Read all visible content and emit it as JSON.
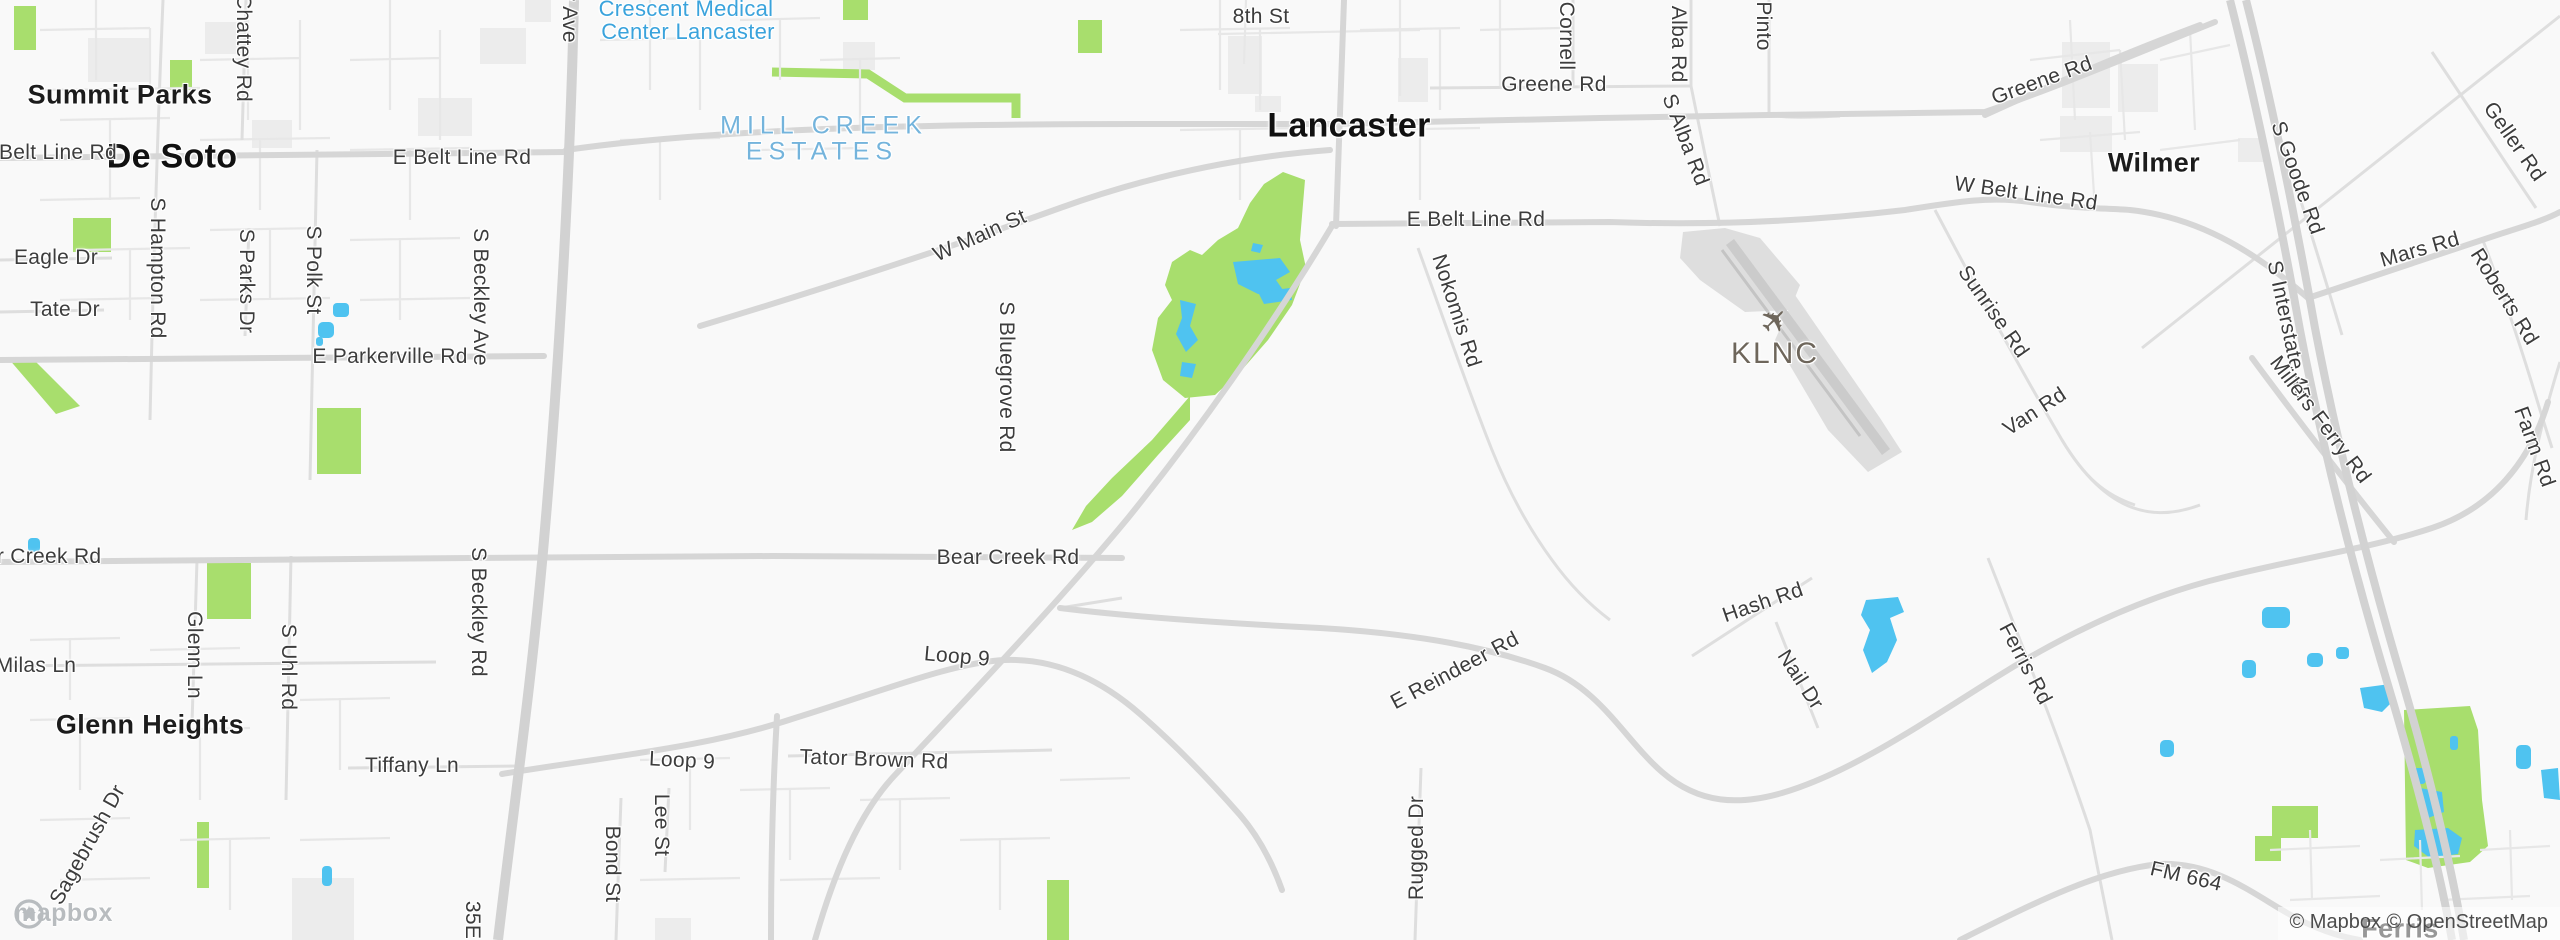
{
  "map": {
    "attribution": "© Mapbox © OpenStreetMap",
    "logo_text": "mapbox"
  },
  "icons": {
    "airplane": "✈",
    "mapbox_badge": "mapbox-circle-badge"
  },
  "colors": {
    "park": "#a8de6d",
    "water": "#4fc3f0",
    "road_major": "#d6d6d6",
    "road_minor": "#e7e7e7",
    "poi_blue": "#3aa3dc",
    "area_blue": "#74b4dc",
    "airport_label": "#6e665b"
  },
  "labels": [
    {
      "n": "summit-parks",
      "t": "Summit Parks",
      "x": 120,
      "y": 95,
      "r": 0,
      "c": "city"
    },
    {
      "n": "de-soto",
      "t": "De Soto",
      "x": 172,
      "y": 157,
      "r": 0,
      "c": "city-lg"
    },
    {
      "n": "lancaster",
      "t": "Lancaster",
      "x": 1349,
      "y": 126,
      "r": 0,
      "c": "city-lg"
    },
    {
      "n": "wilmer",
      "t": "Wilmer",
      "x": 2154,
      "y": 163,
      "r": 0,
      "c": "city"
    },
    {
      "n": "glenn-heights",
      "t": "Glenn Heights",
      "x": 150,
      "y": 725,
      "r": 0,
      "c": "city"
    },
    {
      "n": "ferris",
      "t": "Ferris",
      "x": 2400,
      "y": 929,
      "r": 0,
      "c": "city"
    },
    {
      "n": "belt-line-rd-west-edge",
      "t": "Belt Line Rd",
      "x": 58,
      "y": 153,
      "r": 0
    },
    {
      "n": "e-belt-line-rd-desoto",
      "t": "E Belt Line Rd",
      "x": 462,
      "y": 158,
      "r": 0
    },
    {
      "n": "chattey-rd",
      "t": "Chattey Rd",
      "x": 243,
      "y": 48,
      "r": 90
    },
    {
      "n": "s-hampton-rd",
      "t": "S Hampton Rd",
      "x": 157,
      "y": 268,
      "r": 90
    },
    {
      "n": "eagle-dr",
      "t": "Eagle Dr",
      "x": 56,
      "y": 258,
      "r": 0
    },
    {
      "n": "tate-dr",
      "t": "Tate Dr",
      "x": 65,
      "y": 310,
      "r": 0
    },
    {
      "n": "s-parks-dr",
      "t": "S Parks Dr",
      "x": 246,
      "y": 281,
      "r": 90
    },
    {
      "n": "s-polk-st",
      "t": "S Polk St",
      "x": 313,
      "y": 270,
      "r": 90
    },
    {
      "n": "e-parkerville-rd",
      "t": "E Parkerville Rd",
      "x": 390,
      "y": 357,
      "r": 0
    },
    {
      "n": "s-beckley-ave",
      "t": "S Beckley Ave",
      "x": 480,
      "y": 297,
      "r": 90
    },
    {
      "n": "s-beckley-ave-top",
      "t": "S Beckley Ave",
      "x": 569,
      "y": -26,
      "r": 90
    },
    {
      "n": "w-main-st",
      "t": "W Main St",
      "x": 980,
      "y": 236,
      "r": -24
    },
    {
      "n": "s-bluegrove-rd",
      "t": "S Bluegrove Rd",
      "x": 1006,
      "y": 377,
      "r": 90
    },
    {
      "n": "eighth-st",
      "t": "8th St",
      "x": 1261,
      "y": 17,
      "r": 0
    },
    {
      "n": "greene-rd",
      "t": "Greene Rd",
      "x": 1554,
      "y": 85,
      "r": 0
    },
    {
      "n": "cornell",
      "t": "Cornell",
      "x": 1566,
      "y": 36,
      "r": 90
    },
    {
      "n": "n-alba-rd",
      "t": "N Alba Rd",
      "x": 1678,
      "y": 34,
      "r": 90
    },
    {
      "n": "pinto",
      "t": "Pinto",
      "x": 1763,
      "y": 26,
      "r": 90
    },
    {
      "n": "s-alba-rd",
      "t": "S Alba Rd",
      "x": 1685,
      "y": 140,
      "r": 69
    },
    {
      "n": "e-belt-line-rd-lancaster",
      "t": "E Belt Line Rd",
      "x": 1476,
      "y": 220,
      "r": 0
    },
    {
      "n": "nokomis-rd",
      "t": "Nokomis Rd",
      "x": 1456,
      "y": 311,
      "r": 72
    },
    {
      "n": "klnc",
      "t": "KLNC",
      "x": 1775,
      "y": 354,
      "r": 0,
      "c": "airport"
    },
    {
      "n": "sunrise-rd",
      "t": "Sunrise Rd",
      "x": 1993,
      "y": 312,
      "r": 55
    },
    {
      "n": "van-rd",
      "t": "Van Rd",
      "x": 2035,
      "y": 412,
      "r": -33
    },
    {
      "n": "greene-rd-wilmer",
      "t": "Greene Rd",
      "x": 2042,
      "y": 81,
      "r": -20
    },
    {
      "n": "w-belt-line-rd",
      "t": "W Belt Line Rd",
      "x": 2026,
      "y": 194,
      "r": 8
    },
    {
      "n": "s-goode-rd",
      "t": "S Goode Rd",
      "x": 2297,
      "y": 178,
      "r": 70
    },
    {
      "n": "geller-rd",
      "t": "Geller Rd",
      "x": 2514,
      "y": 142,
      "r": 55
    },
    {
      "n": "mars-rd",
      "t": "Mars Rd",
      "x": 2420,
      "y": 250,
      "r": -16
    },
    {
      "n": "roberts-rd",
      "t": "Roberts Rd",
      "x": 2504,
      "y": 297,
      "r": 58
    },
    {
      "n": "s-interstate-45",
      "t": "S Interstate 45",
      "x": 2288,
      "y": 330,
      "r": 78
    },
    {
      "n": "millers-ferry-rd",
      "t": "Millers Ferry Rd",
      "x": 2320,
      "y": 420,
      "r": 53
    },
    {
      "n": "farm-rd",
      "t": "Farm Rd",
      "x": 2534,
      "y": 447,
      "r": 70
    },
    {
      "n": "bear-creek-rd",
      "t": "Bear Creek Rd",
      "x": 1008,
      "y": 558,
      "r": 0
    },
    {
      "n": "bear-creek-rd-west",
      "t": "Bear Creek Rd",
      "x": 30,
      "y": 557,
      "r": 0
    },
    {
      "n": "milas-ln",
      "t": "Milas Ln",
      "x": 36,
      "y": 666,
      "r": 0
    },
    {
      "n": "glenn-ln",
      "t": "Glenn Ln",
      "x": 194,
      "y": 655,
      "r": 90
    },
    {
      "n": "s-uhl-rd",
      "t": "S Uhl Rd",
      "x": 288,
      "y": 667,
      "r": 90
    },
    {
      "n": "s-beckley-rd",
      "t": "S Beckley Rd",
      "x": 478,
      "y": 612,
      "r": 90
    },
    {
      "n": "loop-9-east",
      "t": "Loop 9",
      "x": 957,
      "y": 657,
      "r": 5
    },
    {
      "n": "loop-9-west",
      "t": "Loop 9",
      "x": 682,
      "y": 761,
      "r": 3
    },
    {
      "n": "tator-brown-rd",
      "t": "Tator Brown Rd",
      "x": 874,
      "y": 760,
      "r": 2
    },
    {
      "n": "tiffany-ln",
      "t": "Tiffany Ln",
      "x": 412,
      "y": 766,
      "r": 0
    },
    {
      "n": "sagebrush-dr",
      "t": "Sagebrush Dr",
      "x": 88,
      "y": 845,
      "r": -61
    },
    {
      "n": "lee-st",
      "t": "Lee St",
      "x": 661,
      "y": 825,
      "r": 90
    },
    {
      "n": "bond-st",
      "t": "Bond St",
      "x": 612,
      "y": 864,
      "r": 90
    },
    {
      "n": "i35e",
      "t": "35E",
      "x": 472,
      "y": 920,
      "r": 90
    },
    {
      "n": "e-reindeer-rd",
      "t": "E Reindeer Rd",
      "x": 1455,
      "y": 671,
      "r": -28
    },
    {
      "n": "rugged-dr",
      "t": "Rugged Dr",
      "x": 1417,
      "y": 848,
      "r": -90
    },
    {
      "n": "hash-rd",
      "t": "Hash Rd",
      "x": 1763,
      "y": 603,
      "r": -19
    },
    {
      "n": "nail-dr",
      "t": "Nail Dr",
      "x": 1800,
      "y": 680,
      "r": 57
    },
    {
      "n": "ferris-rd",
      "t": "Ferris Rd",
      "x": 2025,
      "y": 664,
      "r": 62
    },
    {
      "n": "fm-664",
      "t": "FM 664",
      "x": 2186,
      "y": 877,
      "r": 13
    },
    {
      "n": "crescent-medical-line1",
      "t": "Crescent Medical",
      "x": 686,
      "y": 9,
      "r": 0,
      "c": "poi-blue"
    },
    {
      "n": "crescent-medical-line2",
      "t": "Center Lancaster",
      "x": 688,
      "y": 32,
      "r": 0,
      "c": "poi-blue"
    },
    {
      "n": "mill-creek-estates-line1",
      "t": "MILL CREEK",
      "x": 824,
      "y": 126,
      "r": 0,
      "c": "area-blue"
    },
    {
      "n": "mill-creek-estates-line2",
      "t": "ESTATES",
      "x": 822,
      "y": 152,
      "r": 0,
      "c": "area-blue"
    }
  ]
}
